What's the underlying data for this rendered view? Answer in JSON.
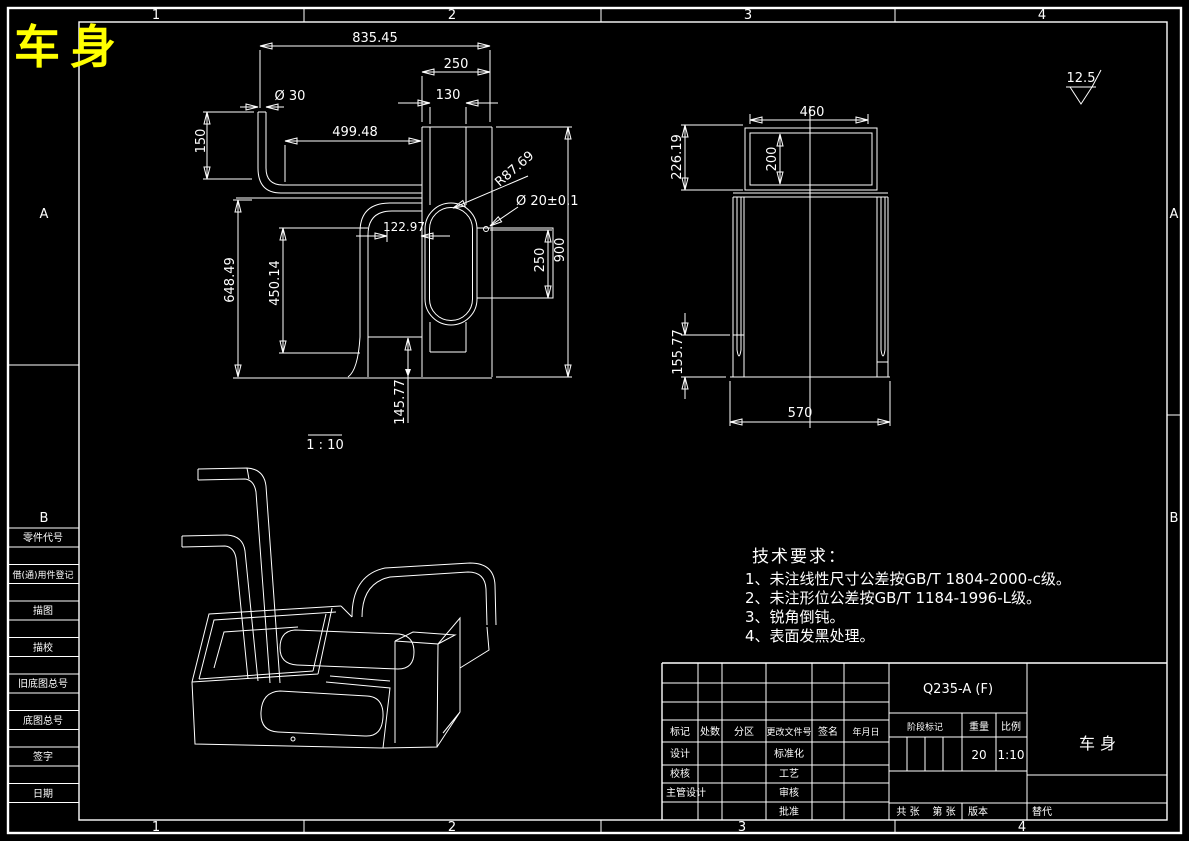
{
  "sheet": {
    "title": "车身",
    "zone_cols": [
      "1",
      "2",
      "3",
      "4"
    ],
    "zone_rows": [
      "A",
      "B"
    ]
  },
  "border_column": {
    "labels": [
      "零件代号",
      "借(通)用件登记",
      "描图",
      "描校",
      "旧底图总号",
      "底图总号",
      "签字",
      "日期"
    ]
  },
  "views": {
    "front": {
      "scale_note": "1 : 10",
      "dims": {
        "total_len": "835.45",
        "col_width": "250",
        "inner_width": "130",
        "tube_dia": "Ø 30",
        "tube_len": "499.48",
        "tube_drop": "150",
        "slot_radius": "R87.69",
        "hole_dia": "Ø 20±0.1",
        "offset": "122.97",
        "body_height": "648.49",
        "plate_height": "450.14",
        "bracket_height": "250",
        "total_height": "900",
        "foot_height": "145.77"
      }
    },
    "side": {
      "dims": {
        "tray_width": "460",
        "tray_depth": "200",
        "tray_height": "226.19",
        "foot_height": "155.77",
        "base_width": "570"
      }
    }
  },
  "surface_finish": {
    "value": "12.5"
  },
  "tech_req": {
    "title": "技术要求：",
    "items": [
      "1、未注线性尺寸公差按GB/T 1804-2000-c级。",
      "2、未注形位公差按GB/T 1184-1996-L级。",
      "3、锐角倒钝。",
      "4、表面发黑处理。"
    ]
  },
  "title_block": {
    "material": "Q235-A (F)",
    "part_name": "车身",
    "header_cols": [
      "标记",
      "处数",
      "分区",
      "更改文件号",
      "签名",
      "年月日"
    ],
    "sign_rows": [
      [
        "设计",
        "标准化"
      ],
      [
        "校核",
        "工艺"
      ],
      [
        "主管设计",
        "审核"
      ],
      [
        "",
        "批准"
      ]
    ],
    "stage_label": "阶段标记",
    "weight_label": "重量",
    "scale_label": "比例",
    "weight_value": "20",
    "scale_value": "1:10",
    "sheet_total": "共 张",
    "sheet_no": "第 张",
    "version_label": "版本",
    "replace_label": "替代"
  }
}
